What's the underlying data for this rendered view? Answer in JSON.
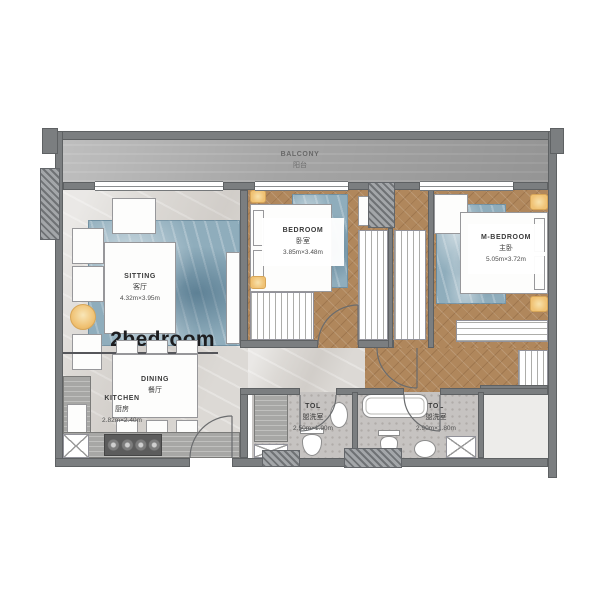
{
  "title": {
    "text": "2bedroom"
  },
  "rooms": {
    "balcony": {
      "en": "BALCONY",
      "cn": "阳台"
    },
    "sitting": {
      "en": "SITTING",
      "cn": "客厅",
      "size": "4.32m×3.95m"
    },
    "dining": {
      "en": "DINING",
      "cn": "餐厅"
    },
    "kitchen": {
      "en": "KITCHEN",
      "cn": "厨房",
      "size": "2.82m×2.40m"
    },
    "bedroom": {
      "en": "BEDROOM",
      "cn": "卧室",
      "size": "3.85m×3.48m"
    },
    "master": {
      "en": "M-BEDROOM",
      "cn": "主卧",
      "size": "5.05m×3.72m"
    },
    "toilet_left": {
      "en": "TOL",
      "cn": "盥洗室",
      "size": "2.50m×1.90m"
    },
    "toilet_right": {
      "en": "TOL",
      "cn": "盥洗室",
      "size": "2.90m×1.80m"
    }
  },
  "colors": {
    "wall": "#7b7e80",
    "balcony": "#a5a5a5",
    "marble": "#dcd9d5",
    "wood": "#b0875c",
    "rug": "#8fadbc",
    "accent": "#f0c274",
    "bath_floor": "#c6c3c1",
    "title_text": "#1d1d1f"
  }
}
